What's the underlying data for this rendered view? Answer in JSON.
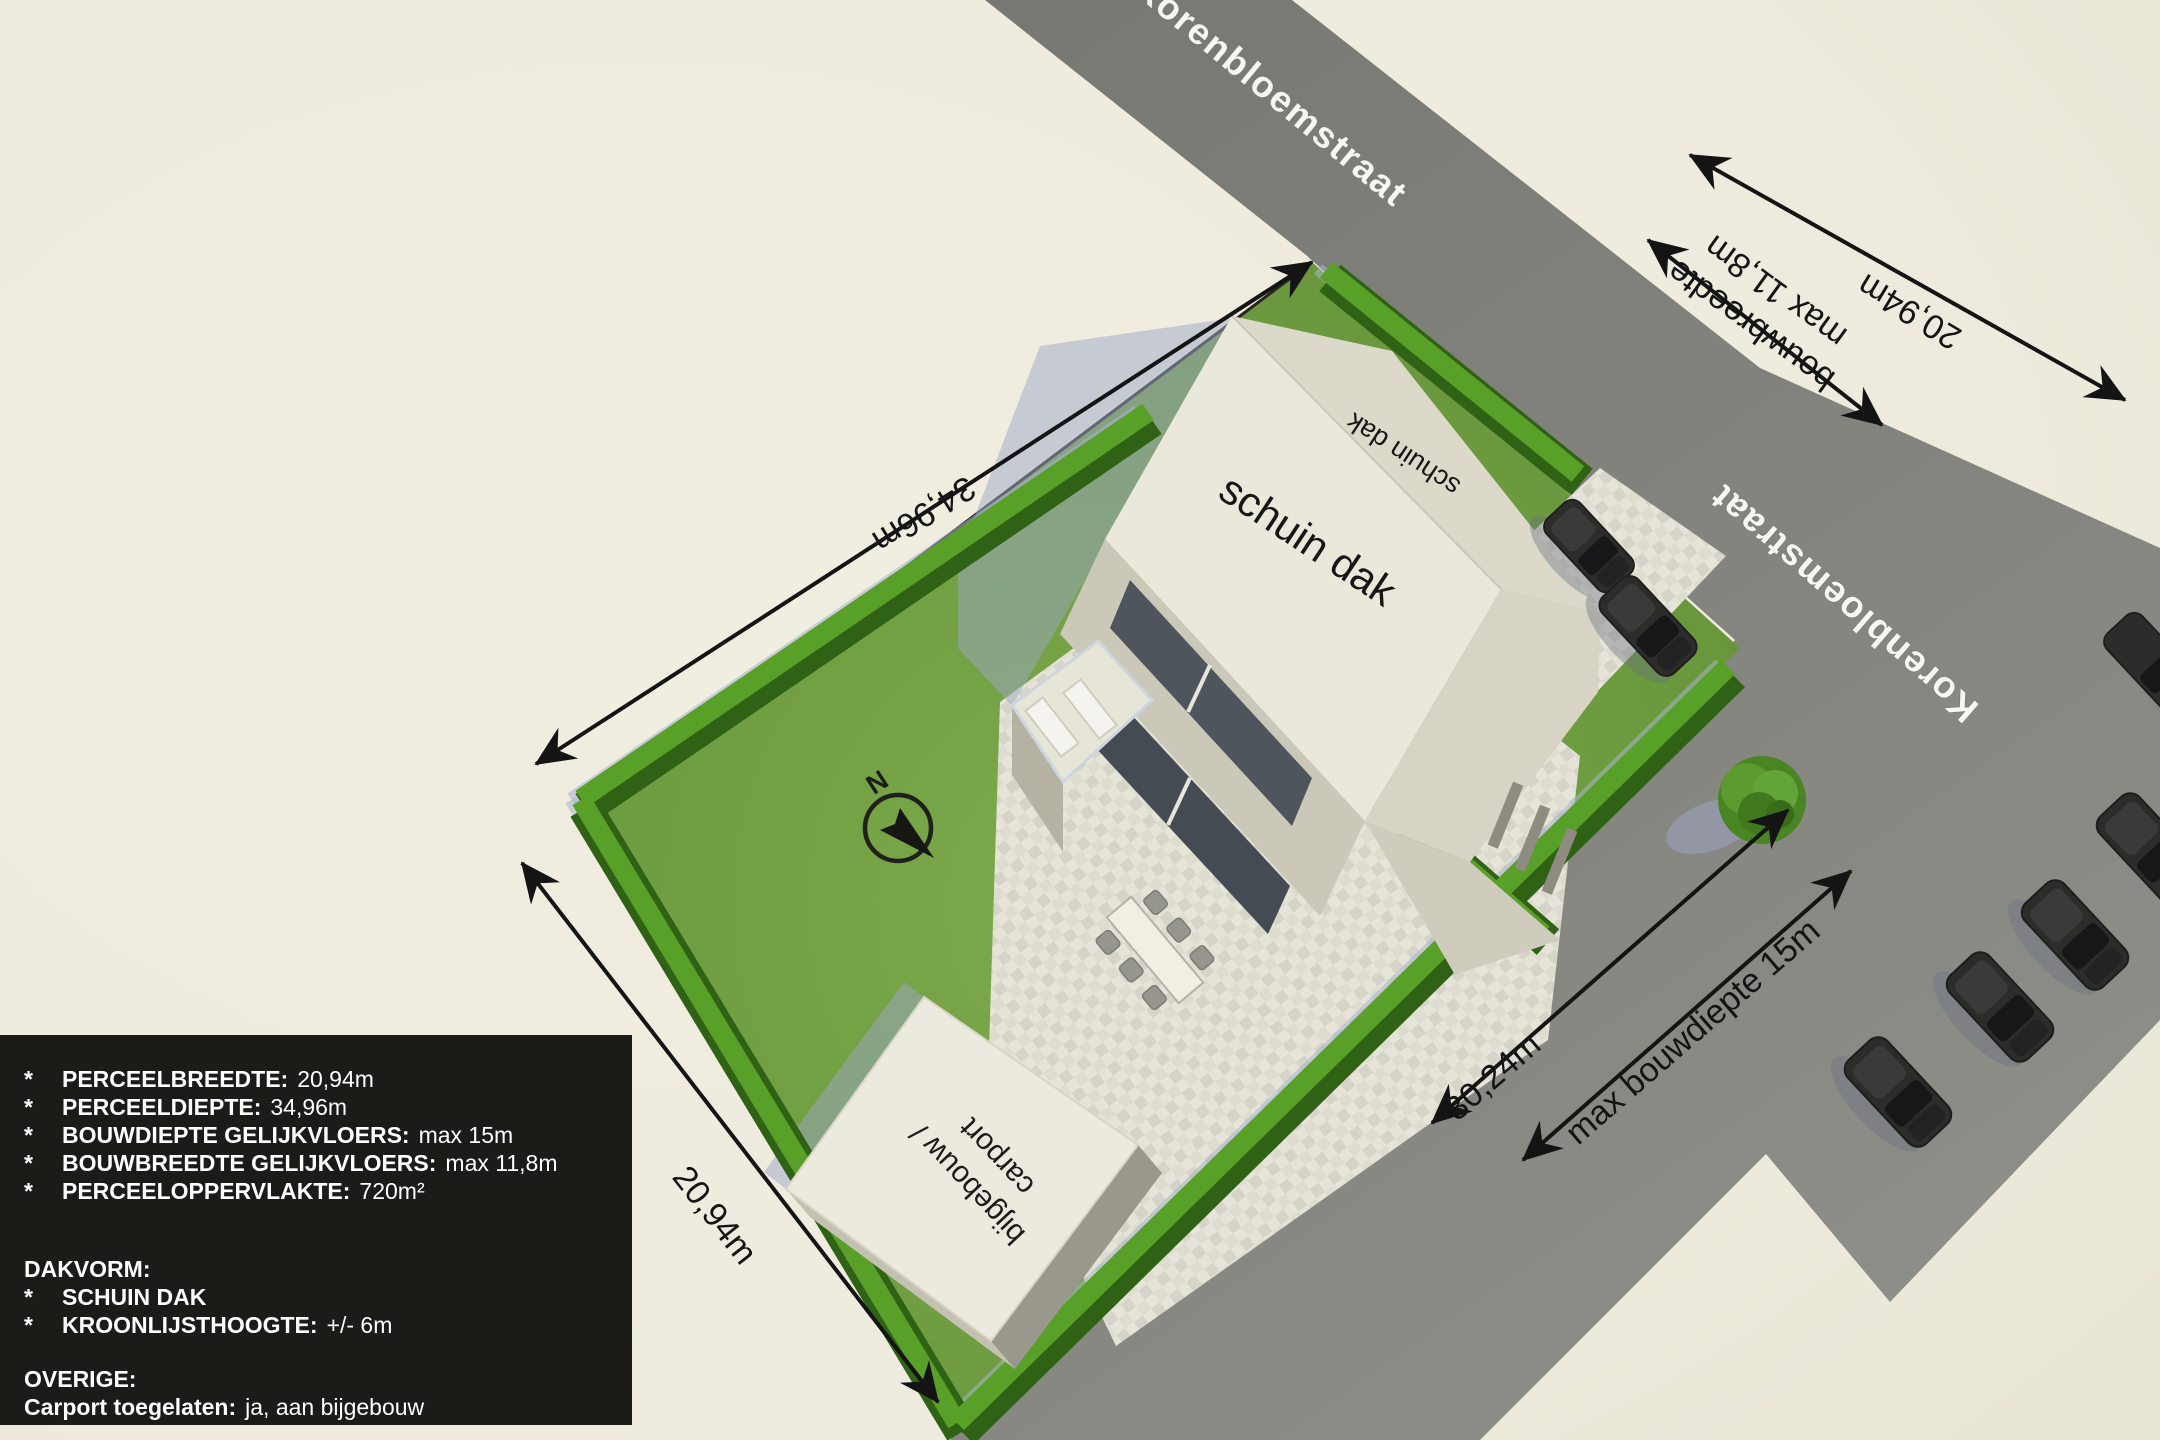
{
  "scene": {
    "compass_label": "N",
    "streets": {
      "top": "Korenbloemstraat",
      "right": "Korenbloemstraat"
    },
    "roof": {
      "front_label": "schuin dak",
      "back_label": "schuin dak"
    },
    "outbuilding": {
      "line1": "bijgebouw /",
      "line2": "carport"
    },
    "dimensions": {
      "plot_depth": "34,96m",
      "plot_width_sw": "20,94m",
      "plot_width_ne": "20,94m",
      "build_width_line1": "bouwbreedte",
      "build_width_line2": "max 11,8m",
      "road_length": "30,24m",
      "build_depth": "max bouwdiepte 15m"
    }
  },
  "info_box": {
    "items": [
      {
        "bullet": "*",
        "label": "PERCEELBREEDTE:",
        "value": "20,94m"
      },
      {
        "bullet": "*",
        "label": "PERCEELDIEPTE:",
        "value": "34,96m"
      },
      {
        "bullet": "*",
        "label": "BOUWDIEPTE GELIJKVLOERS:",
        "value": "max 15m"
      },
      {
        "bullet": "*",
        "label": "BOUWBREEDTE GELIJKVLOERS:",
        "value": "max 11,8m"
      },
      {
        "bullet": "*",
        "label": "PERCEELOPPERVLAKTE:",
        "value": "720m²"
      }
    ],
    "roof_section": {
      "heading": "DAKVORM:",
      "items": [
        {
          "bullet": "*",
          "label": "SCHUIN DAK",
          "value": ""
        },
        {
          "bullet": "*",
          "label": "KROONLIJSTHOOGTE:",
          "value": "+/- 6m"
        }
      ]
    },
    "other_section": {
      "heading": "OVERIGE:",
      "items": [
        {
          "bullet": "",
          "label": "Carport toegelaten:",
          "value": "ja, aan bijgebouw"
        }
      ]
    }
  },
  "colors": {
    "background": "#efecdf",
    "road": "#7e7e78",
    "grass": "#6f9e3e",
    "hedge": "#3c7a1c",
    "hedge_top": "#58a028",
    "paving": "#e3e1d6",
    "house_roof": "#eae8db",
    "shadow": "#a3adc8",
    "car": "#2c2c2a",
    "info_box_bg": "#1b1b18",
    "dimension_line": "#141414",
    "street_text": "#f7f6f2"
  }
}
